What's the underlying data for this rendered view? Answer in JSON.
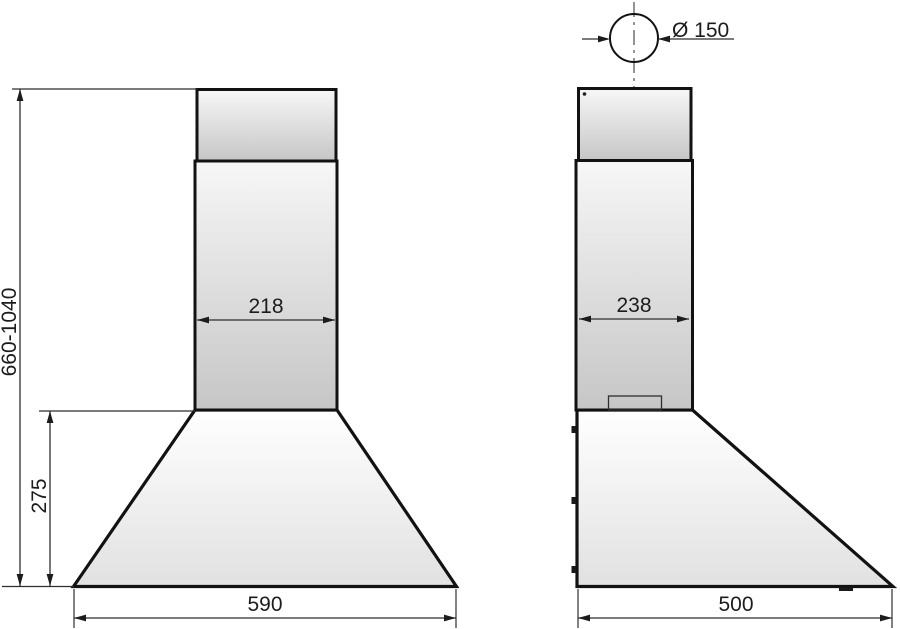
{
  "title": "Cooker hood technical dimension drawing, front and side views",
  "colors": {
    "background": "#ffffff",
    "outline": "#121212",
    "thin_line": "#2e2e2e",
    "centerline": "#5a5a5a",
    "text": "#1c1c1c",
    "fill_light": "#f7f7f7",
    "fill_dark": "#c6c6c6",
    "canopy_light": "#ffffff",
    "canopy_dark": "#e1e1e1"
  },
  "front_view": {
    "name": "front view",
    "height_range_label": "660-1040",
    "canopy_height_label": "275",
    "chimney_width_label": "218",
    "body_width_label": "590"
  },
  "side_view": {
    "name": "side view",
    "duct_diameter_label": "Ø 150",
    "chimney_depth_label": "238",
    "body_depth_label": "500"
  }
}
